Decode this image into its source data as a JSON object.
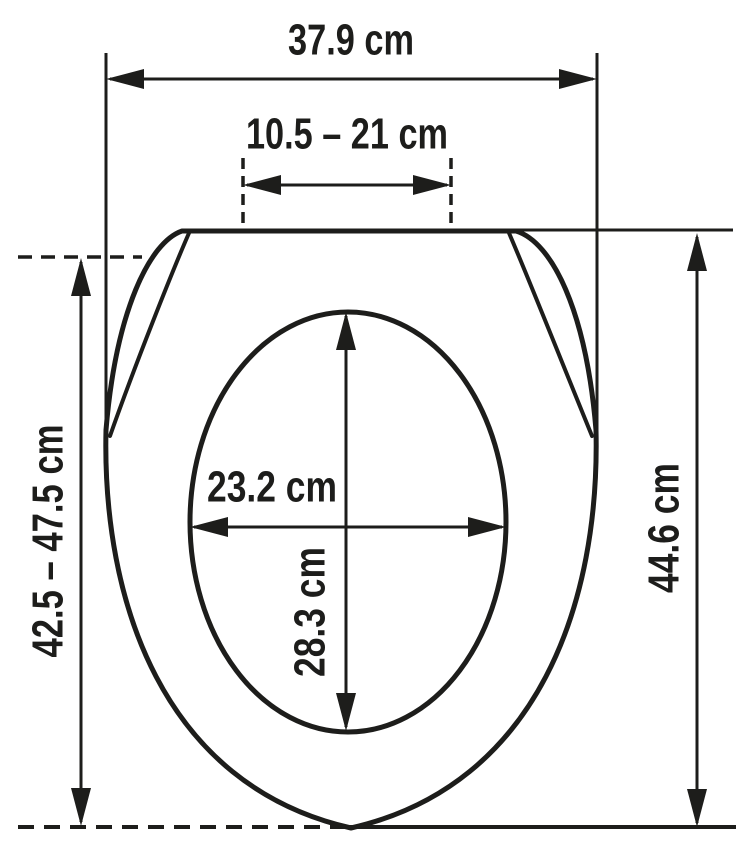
{
  "diagram": {
    "subject": "toilet-seat-dimension-drawing",
    "dims": {
      "outer_width": "37.9 cm",
      "hinge_spacing": "10.5 – 21 cm",
      "inner_width": "23.2 cm",
      "inner_depth": "28.3 cm",
      "overall_length_range": "42.5 – 47.5 cm",
      "overall_length": "44.6 cm"
    },
    "colors": {
      "line": "#1d1d1b",
      "background": "#ffffff"
    }
  }
}
